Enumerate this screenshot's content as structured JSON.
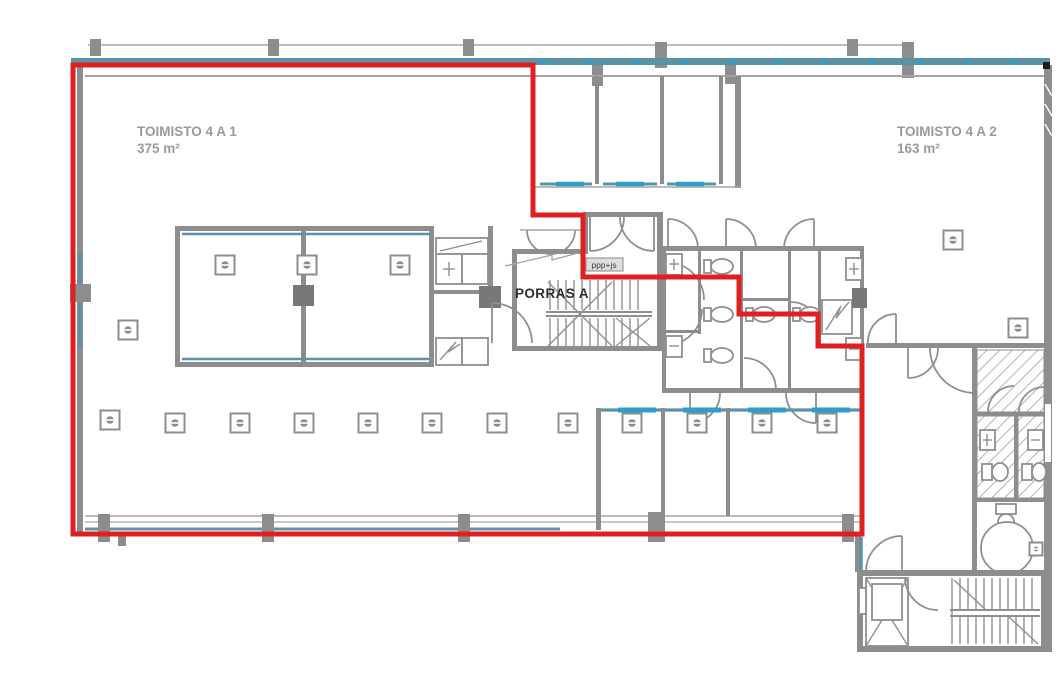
{
  "labels": {
    "office1_name": "TOIMISTO 4 A 1",
    "office1_area": "375 m²",
    "office2_name": "TOIMISTO 4 A 2",
    "office2_area": "163 m²",
    "stairwell_name": "PORRAS A",
    "riser_note": "ppp+js"
  },
  "colors": {
    "boundary_red": "#e01f1f",
    "wall_gray": "#8d8d8d",
    "glazing_teal": "#5a92a8",
    "glazing_cyan": "#2e9ec6",
    "label_gray": "#9a9a9a",
    "text_dark": "#2e2e2e",
    "background": "#ffffff"
  },
  "red_boundary": {
    "points": "73,65 533,65 533,215 583,215 583,277 739,277 739,314 818,314 818,346 862,346 862,534 73,534 73,65",
    "stroke_width": 5
  },
  "ceiling_symbols": {
    "large": [
      [
        225,
        265
      ],
      [
        307,
        265
      ],
      [
        400,
        265
      ],
      [
        128,
        330
      ],
      [
        953,
        240
      ],
      [
        1018,
        328
      ],
      [
        110,
        420
      ],
      [
        175,
        423
      ],
      [
        240,
        423
      ],
      [
        304,
        423
      ],
      [
        368,
        423
      ],
      [
        432,
        423
      ],
      [
        497,
        423
      ],
      [
        568,
        423
      ],
      [
        632,
        423
      ],
      [
        697,
        423
      ],
      [
        762,
        423
      ],
      [
        827,
        423
      ]
    ],
    "small": [
      [
        1036,
        549
      ]
    ]
  }
}
